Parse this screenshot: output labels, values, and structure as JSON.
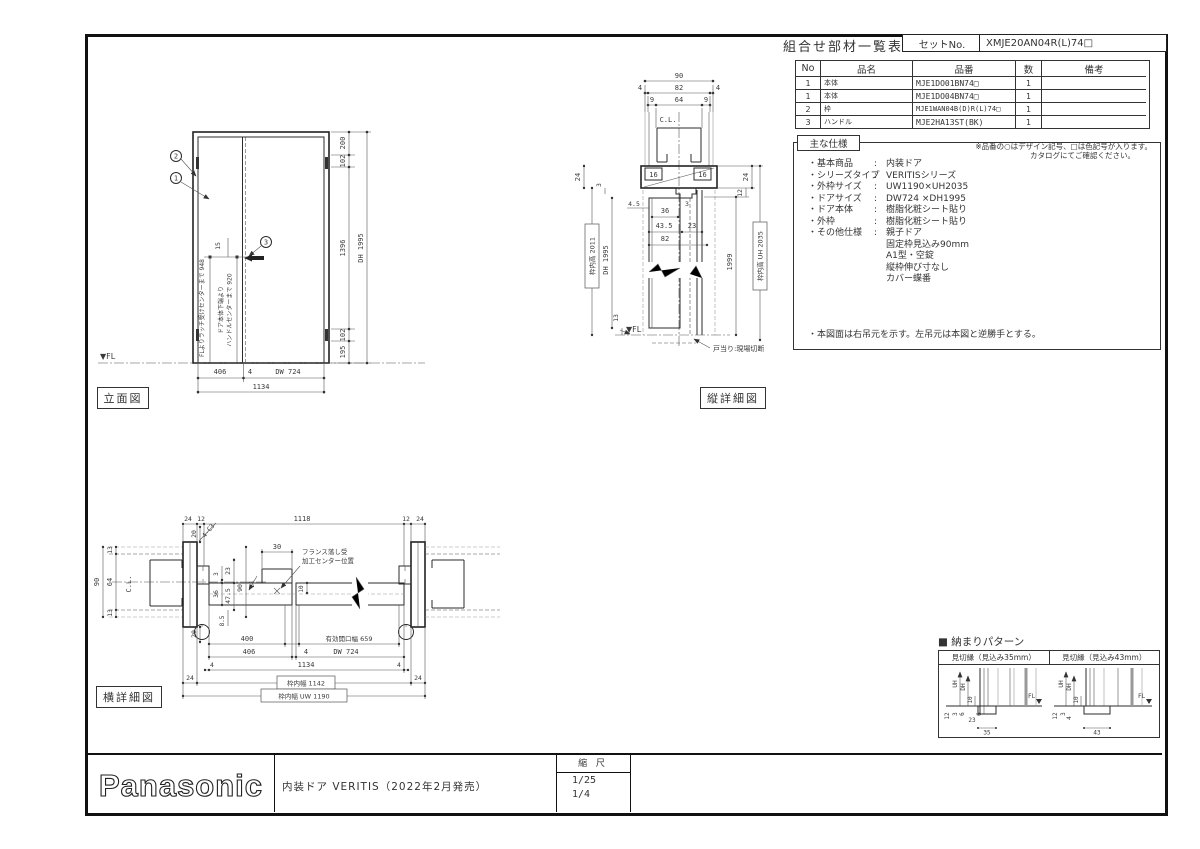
{
  "header": {
    "title": "組合せ部材一覧表",
    "set_label": "セットNo.",
    "set_value": "XMJE20AN04R(L)74□"
  },
  "parts_table": {
    "headers": [
      "No",
      "品名",
      "品番",
      "数",
      "備考"
    ],
    "rows": [
      {
        "no": "1",
        "name": "本体",
        "number": "MJE1DO01BN74□",
        "qty": "1",
        "note": ""
      },
      {
        "no": "1",
        "name": "本体",
        "number": "MJE1DO04BN74□",
        "qty": "1",
        "note": ""
      },
      {
        "no": "2",
        "name": "枠",
        "number": "MJE1WAN04B(D)R(L)74□",
        "qty": "1",
        "note": ""
      },
      {
        "no": "3",
        "name": "ハンドル",
        "number": "MJE2HA13ST(BK)",
        "qty": "1",
        "note": ""
      }
    ],
    "note1": "※品番の○はデザイン記号、□は色記号が入ります。",
    "note2": "カタログにてご確認ください。"
  },
  "specs": {
    "title": "主な仕様",
    "colon": ":",
    "items": [
      {
        "label": "・基本商品",
        "value": "内装ドア"
      },
      {
        "label": "・シリーズタイプ",
        "value": "VERITISシリーズ"
      },
      {
        "label": "・外枠サイズ",
        "value": "UW1190×UH2035"
      },
      {
        "label": "・ドアサイズ",
        "value": "DW724 ×DH1995"
      },
      {
        "label": "・ドア本体",
        "value": "樹脂化粧シート貼り"
      },
      {
        "label": "・外枠",
        "value": "樹脂化粧シート貼り"
      },
      {
        "label": "・その他仕様",
        "value": "親子ドア"
      }
    ],
    "extras": [
      "固定枠見込み90mm",
      "A1型・空錠",
      "縦枠伸び寸なし",
      "カバー蝶番"
    ],
    "note": "・本図面は右吊元を示す。左吊元は本図と逆勝手とする。"
  },
  "elevation": {
    "label": "立面図",
    "fl": "▼FL",
    "balloons": {
      "b1": "1",
      "b2": "2",
      "b3": "3"
    },
    "bottom": {
      "d406": "406",
      "d4": "4",
      "dw": "DW 724",
      "total": "1134"
    },
    "right": {
      "d200": "200",
      "d102a": "102",
      "d1396": "1396",
      "d102b": "102",
      "d195": "195",
      "dh": "DH 1995"
    },
    "left": {
      "latch": "FLよりラッチ受けセンターまで 948",
      "handle1": "ドア本体下端より",
      "handle2": "ハンドルセンターまで 920",
      "d15": "15"
    }
  },
  "vsection": {
    "label": "縦詳細図",
    "cl": "C.L.",
    "fl": "▼FL",
    "note": "戸当り:現場切断",
    "top": {
      "d90": "90",
      "d4a": "4",
      "d82": "82",
      "d4b": "4",
      "d9a": "9",
      "d64": "64",
      "d9b": "9",
      "d16a": "16",
      "d16b": "16"
    },
    "left": {
      "d24": "24",
      "d3": "3",
      "boxed": "枠内高 2011",
      "dh": "DH 1995",
      "d13": "13"
    },
    "mid": {
      "d45": "4.5",
      "d36": "36",
      "d3": "3",
      "d435": "43.5",
      "d23": "23",
      "d82": "82"
    },
    "right": {
      "d24": "24",
      "d12": "12",
      "d1999": "1999",
      "boxed": "枠内高 UH 2035"
    }
  },
  "hsection": {
    "label": "横詳細図",
    "cl": "C.L.",
    "chamfer": "4-C3",
    "top": {
      "d24a": "24",
      "d12a": "12",
      "d1118": "1118",
      "d12b": "12",
      "d24b": "24"
    },
    "left": {
      "d90": "90",
      "d13a": "13",
      "d64": "64",
      "d13b": "13",
      "d20a": "20",
      "d20b": "20"
    },
    "mid": {
      "d30": "30",
      "d10": "10",
      "d21": "21",
      "d3": "3",
      "d36": "36",
      "d23": "23",
      "d475": "47.5",
      "d90": "90",
      "d85": "8.5",
      "note1": "フランス落し受",
      "note2": "加工センター位置"
    },
    "bottom": {
      "d400": "400",
      "eff": "有効開口幅 659",
      "d406": "406",
      "d4a": "4",
      "dw": "DW 724",
      "d4b": "4",
      "d1134": "1134",
      "d4c": "4",
      "d24a": "24",
      "d24b": "24",
      "w1142": "枠内幅 1142",
      "uw": "枠内幅 UW 1190"
    }
  },
  "pattern": {
    "title": "■ 納まりパターン",
    "left_header": "見切縁（見込み35mm）",
    "right_header": "見切縁（見込み43mm）",
    "left": {
      "uh": "UH",
      "dh": "DH",
      "d10": "10",
      "fl": "FL",
      "d12": "12",
      "d3": "3",
      "d6a": "6",
      "d23": "23",
      "d6b": "6",
      "d35": "35"
    },
    "right": {
      "uh": "UH",
      "dh": "DH",
      "d10": "10",
      "fl": "FL",
      "d12": "12",
      "d3": "3",
      "d4": "4",
      "d43": "43"
    }
  },
  "title_block": {
    "logo": "Panasonic",
    "description": "内装ドア VERITIS（2022年2月発売）",
    "scale_label": "縮 尺",
    "scale1": "1/25",
    "scale2": "1/4"
  }
}
